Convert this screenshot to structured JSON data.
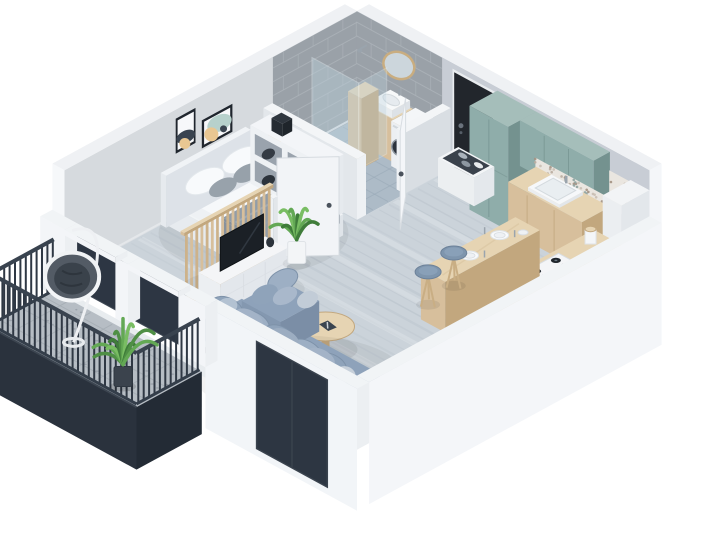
{
  "canvas": {
    "width": 714,
    "height": 555
  },
  "scene": {
    "type": "isometric-3d-floorplan-render",
    "description": "cutaway axonometric render of a studio apartment with balcony",
    "rooms": [
      {
        "name": "bedroom",
        "items": [
          "double-bed",
          "nightstand",
          "table-lamp",
          "wall-art",
          "wall-art",
          "cube-shelf-unit"
        ]
      },
      {
        "name": "bathroom",
        "items": [
          "walk-in-shower",
          "glass-screen",
          "wood-cabinet",
          "toilet",
          "vanity-sink",
          "round-mirror",
          "washing-machine"
        ]
      },
      {
        "name": "entry",
        "items": [
          "front-door",
          "shoe-bench"
        ]
      },
      {
        "name": "kitchen",
        "items": [
          "tall-cabinet",
          "upper-cabinets",
          "base-cabinets",
          "kitchen-sink",
          "gas-hob",
          "kitchen-counter",
          "breakfast-bar",
          "bar-stool",
          "bar-stool",
          "storage-jar"
        ]
      },
      {
        "name": "living-room",
        "items": [
          "corner-sofa",
          "coffee-table",
          "tv-console",
          "tv",
          "slat-partition",
          "potted-plant",
          "interior-door",
          "interior-door"
        ]
      },
      {
        "name": "balcony",
        "items": [
          "hanging-egg-chair",
          "potted-palm",
          "railing",
          "balcony-doors"
        ]
      }
    ]
  },
  "colors": {
    "background": "#ffffff",
    "wall_left": "#d6dade",
    "wall_right": "#c8cdd5",
    "wall_top": "#eff1f4",
    "wall_cut": "#f3f5f7",
    "wall_face_a": "#e8ebef",
    "tile_wall": "#9aa1a8",
    "tile_grout": "#adb4ba",
    "bath_floor": "#adbbc7",
    "bath_line": "#9aaab8",
    "floor_main": "#cbd3da",
    "floor_plank": "#b2bcc6",
    "floor_light": "#dde3e8",
    "balcony_floor": "#b6bdc4",
    "door_black": "#22262c",
    "door_white": "#f4f6f9",
    "navy": "#2d3642",
    "teal": "#8fadaa",
    "teal_dark": "#74928f",
    "teal_light": "#a5beba",
    "wood": "#d7bf9c",
    "wood_dark": "#c2a77e",
    "wood_light": "#e6d4b3",
    "marble": "#f4f5f7",
    "tv": "#1b2026",
    "sofa": "#8ea2ba",
    "sofa_dark": "#7b8ea6",
    "cushion_light": "#c7d0da",
    "cushion_mid": "#a3b3c7",
    "plant": "#63a855",
    "plant_dark": "#3f7c3a",
    "white_f": "#f3f5f8",
    "grey_blanket": "#929da8",
    "pillow_grey": "#97a1aa",
    "lamp_wood": "#e4c89e",
    "mirror": "#ccd6dc",
    "stool": "#7e95ad",
    "art_navy": "#3a4450",
    "art_tan": "#e9c792",
    "art_teal": "#b7d1cc",
    "glass": "#bdd3de",
    "railing": "#2f3844",
    "fascia_a": "#2a323d",
    "fascia_b": "#232b35"
  }
}
